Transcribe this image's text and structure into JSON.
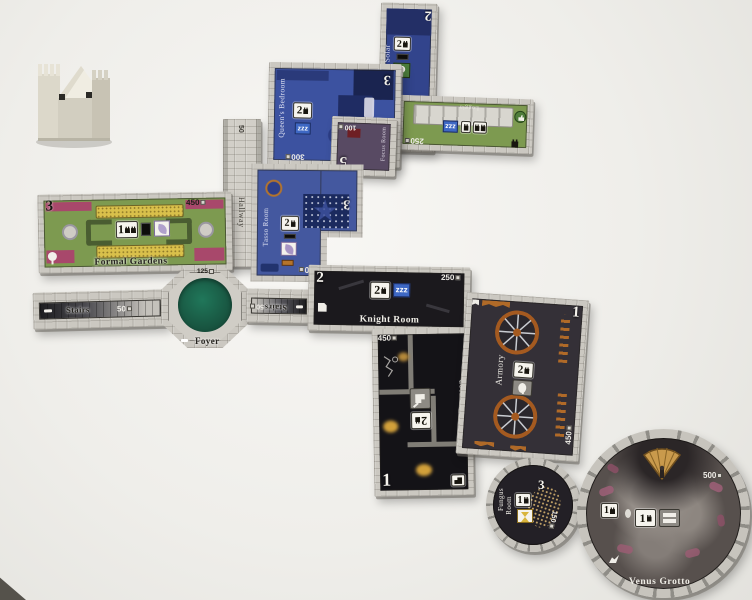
{
  "board": {
    "zzz": "zzz",
    "tiles": {
      "solar": {
        "name": "Solar",
        "price": "300",
        "corner_number": "2",
        "door_number": "2"
      },
      "loggia": {
        "name": "Loggia",
        "price": "250"
      },
      "queens_bedroom": {
        "name": "Queen's Bedroom",
        "price": "300",
        "corner_number": "3",
        "door_number": "2"
      },
      "focus_room": {
        "name": "Focus Room",
        "price": "100",
        "corner_number": "5"
      },
      "hallway": {
        "name": "Hallway",
        "price": "50"
      },
      "tasso_room": {
        "name": "Tasso Room",
        "price": "300",
        "corner_number": "3",
        "door_number": "2"
      },
      "formal_gardens": {
        "name": "Formal Gardens",
        "price": "450",
        "corner_number": "3",
        "door_number": "1"
      },
      "stairs_west": {
        "name": "Stairs",
        "price": "50"
      },
      "foyer": {
        "name": "Foyer",
        "price": "125"
      },
      "stairs_east": {
        "name": "Stairs",
        "price": "50"
      },
      "knight_room": {
        "name": "Knight Room",
        "price": "250",
        "corner_number": "2",
        "door_number": "2"
      },
      "dungeon": {
        "name": "Dungeon",
        "price": "450",
        "corner_number": "1",
        "door_number": "2"
      },
      "armory": {
        "name": "Armory",
        "price": "450",
        "corner_number": "1",
        "door_number": "2"
      },
      "fungus_room": {
        "name_line1": "Fungus",
        "name_line2": "Room",
        "price": "150",
        "corner_number": "3",
        "door_number": "1"
      },
      "venus_grotto": {
        "name": "Venus Grotto",
        "price": "500",
        "door_number": "1",
        "bonus_door_number": "1"
      }
    },
    "colors": {
      "stone_wall": "#cbc8c1",
      "sleeping_blue": "#3c52a0",
      "outdoor_green": "#7d9a50",
      "activity_purple": "#584a63",
      "downstairs_black": "#1b191d",
      "foyer_green": "#1d6a50",
      "accent_orange": "#b36a28",
      "flower_magenta": "#a8486b",
      "flower_yellow": "#d9c04b"
    }
  }
}
